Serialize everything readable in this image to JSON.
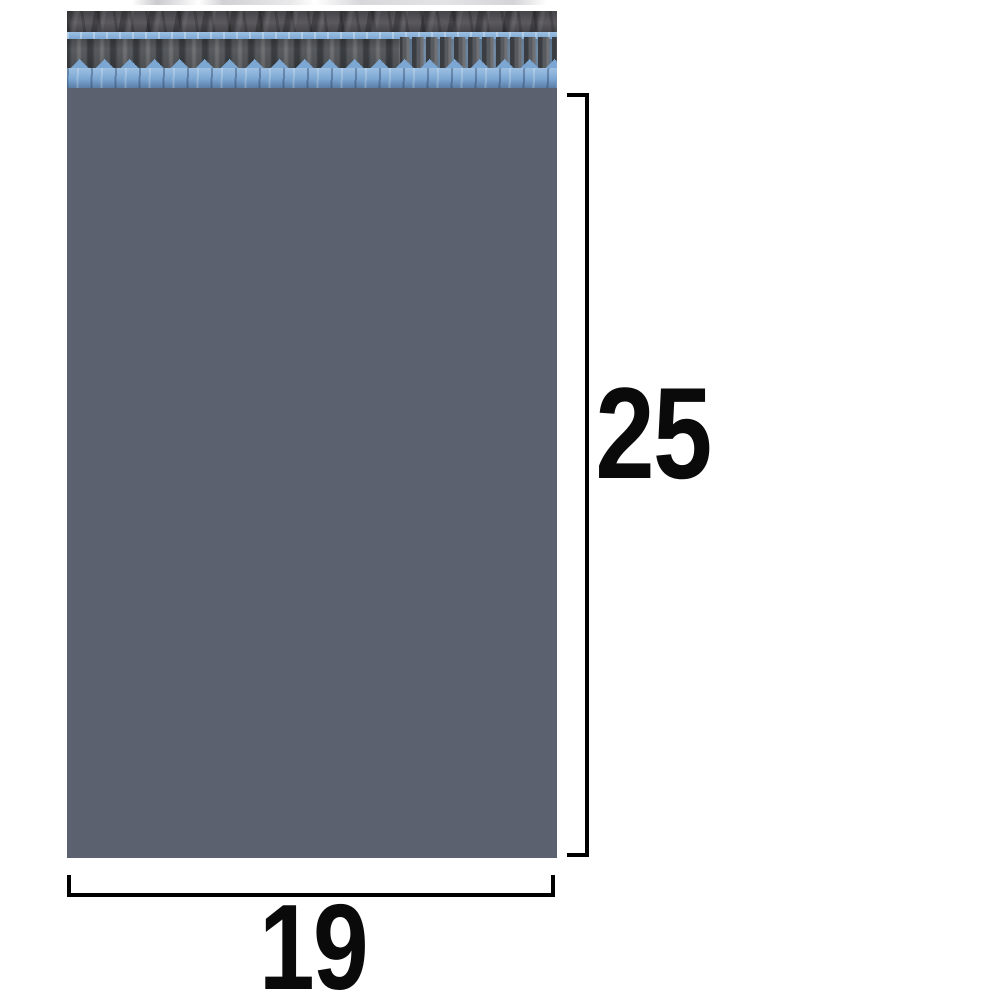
{
  "canvas": {
    "width": 1000,
    "height": 1000
  },
  "colors": {
    "background": "#ffffff",
    "bag_body": "#5c6170",
    "flap_base": "#5b595d",
    "flap_dark": "#454448",
    "pleat_dark": "#3a3d41",
    "pleat_mid": "#575a5e",
    "pleat_light": "#707174",
    "strip_light": "#9dc0e2",
    "strip_mid": "#7ca7d3",
    "strip_shadow": "#5a7ea6",
    "dimension_line": "#000000",
    "dimension_text": "#0a0a0a"
  },
  "annotations": {
    "height_label": "25",
    "width_label": "19"
  }
}
